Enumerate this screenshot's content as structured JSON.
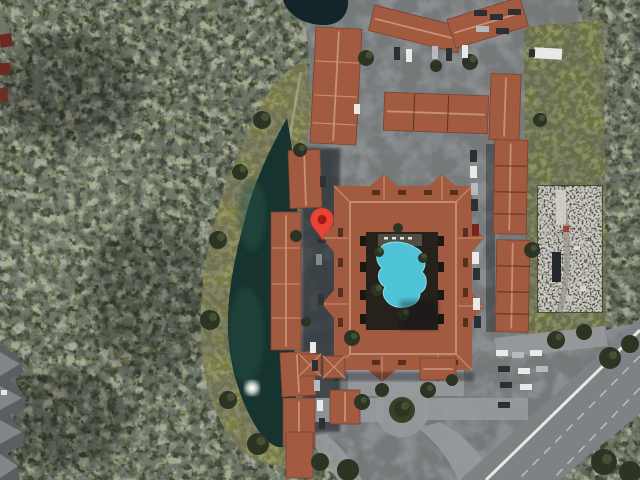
{
  "app": {
    "type": "satellite-map-view",
    "description": "Aerial satellite imagery of a condominium complex with a courtyard swimming pool, retention pond with fountain, parking areas, a storage yard and a main road, surrounded by dense woodland. A red map pin marks a unit on the west side of the courtyard building."
  },
  "marker": {
    "kind": "map-pin",
    "transform": "translate(322,240)",
    "label": ""
  },
  "features": [
    {
      "name": "location-pin",
      "kind": "map marker"
    },
    {
      "name": "courtyard-building",
      "kind": "large square condo block with interior pool courtyard"
    },
    {
      "name": "swimming-pool",
      "kind": "irregular turquoise pool with palm trees"
    },
    {
      "name": "retention-pond",
      "kind": "dark kidney-shaped pond with fountain"
    },
    {
      "name": "pond-fountain",
      "kind": "white aerator plume"
    },
    {
      "name": "grass-bank",
      "kind": "mowed olive embankment around pond"
    },
    {
      "name": "west-building-row",
      "kind": "red tile roofed row buildings"
    },
    {
      "name": "north-buildings",
      "kind": "red tile roofed buildings and parking"
    },
    {
      "name": "east-building-row",
      "kind": "long red tile roofed building"
    },
    {
      "name": "storage-yard",
      "kind": "fenced cluttered equipment yard"
    },
    {
      "name": "grass-field",
      "kind": "open olive field"
    },
    {
      "name": "roundabout",
      "kind": "circular driveway with landscaped island"
    },
    {
      "name": "main-road",
      "kind": "divided road with sidewalk, bottom right"
    },
    {
      "name": "parking-lots",
      "kind": "several lots with parked cars"
    },
    {
      "name": "forest",
      "kind": "dense mixed woodland"
    }
  ],
  "palette": {
    "forest": "#3c4233",
    "forest_light": "#8d9183",
    "forest_olive": "#6b7040",
    "ground": "#8b8e90",
    "road": "#7e8285",
    "sidewalk": "#eae8e0",
    "lane": "#c6c9cb",
    "grass": "#7b7b47",
    "grass_light": "#b4ad85",
    "field": "#6d7242",
    "water": "#17332f",
    "water_dark": "#122528",
    "pool": "#4fc4d8",
    "pool_light": "#8fdde9",
    "roof": "#a25b41",
    "roof_light": "#c79273",
    "roof_dark": "#7a4130",
    "roof_shadow": "#5e3222",
    "courtyard": "#26221b",
    "island": "#36412a",
    "tree": "#2c3423",
    "tree_light": "#5c6a42",
    "junkyard": "#57554b",
    "junkyard_line": "#3a3a31",
    "gray_roof": "#5c5f61",
    "gray_roof_light": "#93979a",
    "car_white": "#e9e9e7",
    "car_silver": "#b7babc",
    "car_dark": "#2d3033",
    "car_red": "#7c241c",
    "pin": "#ea4335",
    "pin_dot": "#a31a12",
    "fountain": "#dfe6de",
    "shed_red": "#6e2a22"
  }
}
